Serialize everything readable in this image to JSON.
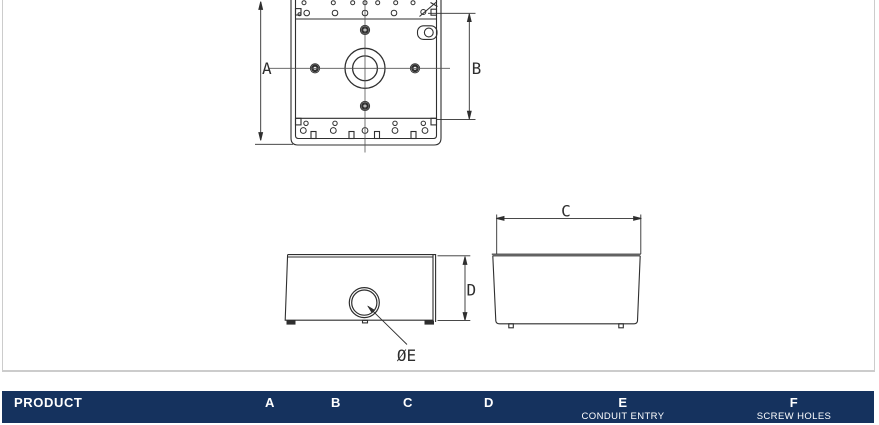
{
  "card": {
    "border_color": "#cccccc",
    "background": "#ffffff"
  },
  "drawing": {
    "line_color": "#2f2f2f",
    "centerline_color": "#555555",
    "labels": {
      "dim_a": "A",
      "dim_b": "B",
      "dim_c": "C",
      "dim_d": "D",
      "conduit_diameter": "ØE"
    }
  },
  "table": {
    "header_bg": "#15325e",
    "header_text_color": "#ffffff",
    "columns": [
      {
        "label": "PRODUCT",
        "sublabel": ""
      },
      {
        "label": "A",
        "sublabel": ""
      },
      {
        "label": "B",
        "sublabel": ""
      },
      {
        "label": "C",
        "sublabel": ""
      },
      {
        "label": "D",
        "sublabel": ""
      },
      {
        "label": "E",
        "sublabel": "CONDUIT ENTRY"
      },
      {
        "label": "F",
        "sublabel": "SCREW HOLES"
      }
    ]
  }
}
